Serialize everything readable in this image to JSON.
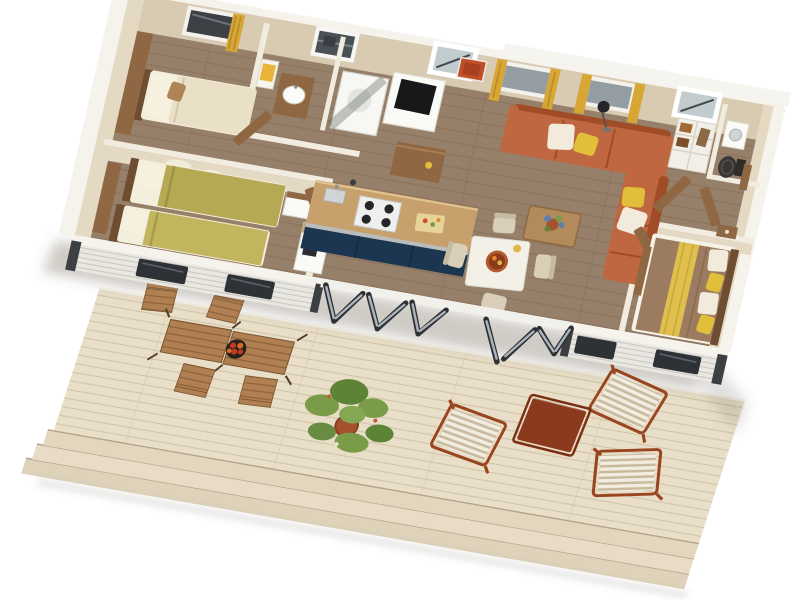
{
  "scene": {
    "type": "3d-floor-plan-render",
    "view": "top-down-isometric",
    "rooms": [
      {
        "name": "bedroom-double",
        "items": [
          "double-bed-cream",
          "wood-headboard-panel",
          "pillows",
          "tan-cushion",
          "window-gold-curtain"
        ]
      },
      {
        "name": "bedroom-twin",
        "items": [
          "single-bed-olive",
          "single-bed-olive",
          "cloud-wall-decals",
          "nightstand"
        ]
      },
      {
        "name": "bathroom-shower",
        "items": [
          "towel-shelf-yellow-towel",
          "vanity-white-sink",
          "shower-cubicle-smoked-glass",
          "grey-blind-window"
        ]
      },
      {
        "name": "kitchen",
        "items": [
          "island-counter-wood-top-navy-front",
          "gas-hob-4-burner",
          "sink",
          "cutting-board",
          "coffee-machine",
          "tv-column",
          "wood-sideboard"
        ]
      },
      {
        "name": "living-room",
        "items": [
          "corner-sofa-terracotta",
          "cushion-white",
          "cushion-yellow",
          "coffee-table-blue-flower-plant",
          "floor-lamp",
          "wall-art-orange",
          "windows-gold-curtains"
        ]
      },
      {
        "name": "dining-area",
        "items": [
          "white-dining-table",
          "cream-chairs-x3",
          "rust-serving-tray"
        ]
      },
      {
        "name": "hallway-wardrobe",
        "items": [
          "shelf-unit-with-clothes",
          "open-wood-doors"
        ]
      },
      {
        "name": "bathroom-wc",
        "items": [
          "dark-toilet",
          "washing-machine",
          "skylight"
        ]
      },
      {
        "name": "bedroom-master",
        "items": [
          "double-bed-taupe",
          "yellow-runner",
          "pillows-white-yellow",
          "wood-bench",
          "nightstand"
        ]
      }
    ],
    "exterior": {
      "deck_items": [
        "bistro-table-pair",
        "bistro-chairs-x4",
        "fruit-bowl-red",
        "potted-plant",
        "striped-lounger-x3",
        "red-side-table",
        "deck-steps-x3"
      ],
      "building_features": [
        "bifold-glass-doors-open",
        "skylight-x2",
        "white-siding",
        "front-windows",
        "roof-edge"
      ]
    }
  },
  "palette": {
    "page": {
      "bg": "#ffffff"
    },
    "building": {
      "wall-top": "#f5f3ec",
      "wall-face": "#d9cbb1",
      "wall-face-light": "#e4d9c3",
      "floor": "#97806a",
      "floor-gap": "#7e654f",
      "siding": "#e9e7e1",
      "siding-gap": "#c9c6bf",
      "window-dark": "#3d4145",
      "frame-dark": "#2e3237",
      "glass": "#c2cbce",
      "glass-light": "#939da2",
      "curtain": "#d7a634",
      "curtain-dark": "#b5882a",
      "art": "#bf4f28"
    },
    "furniture": {
      "wood": "#8f6743",
      "wood-dark": "#6e4d31",
      "white-goods": "#fafaf7",
      "bed-cream": "#eae0c8",
      "pillow": "#f4eedc",
      "tan": "#b08354",
      "olive": "#b5a954",
      "olive2": "#c1b65e",
      "sofa": "#bf6740",
      "sofa-dark": "#a04d27",
      "cushion-white": "#f2ebdb",
      "cushion-yellow": "#e2bf3a",
      "counter": "#c8a06c",
      "cabinet-navy": "#1c3550",
      "steel": "#b9bdbd",
      "hob": "#eef0f0",
      "burner": "#26262a",
      "table-white": "#f3f0e8",
      "chair": "#d9cfb8",
      "chair-dark": "#c6bba1",
      "tray": "#b05a2a",
      "tray-dark": "#8c3a1d",
      "duvet": "#9c7c60",
      "runner": "#e0bf4d",
      "towel": "#e8b53a",
      "toilet": "#3a3634",
      "plant": "#7a9c49",
      "plant-dark": "#5d8336",
      "pot": "#a5522d",
      "flower-blue": "#5b7fae"
    },
    "deck": {
      "wood": "#e9dfc9",
      "gap": "#cdbfa3",
      "step1": "#e2d6bf",
      "step2": "#e8dcc6",
      "step3": "#ded2bb",
      "shadow": "rgba(96,84,66,0.30)",
      "bistro-wood": "#b07f52",
      "bistro-gap": "#8a6238",
      "bistro-metal": "#53402e",
      "fruit": "#c13a1e",
      "fruit2": "#d86a24",
      "bowl": "#2a211c",
      "lounger-white": "#f2ede1",
      "lounger-stripe": "#c9ba9e",
      "lounger-frame": "#99451f",
      "side-table": "#8c3a1d",
      "side-table-dark": "#7b2f12"
    }
  }
}
